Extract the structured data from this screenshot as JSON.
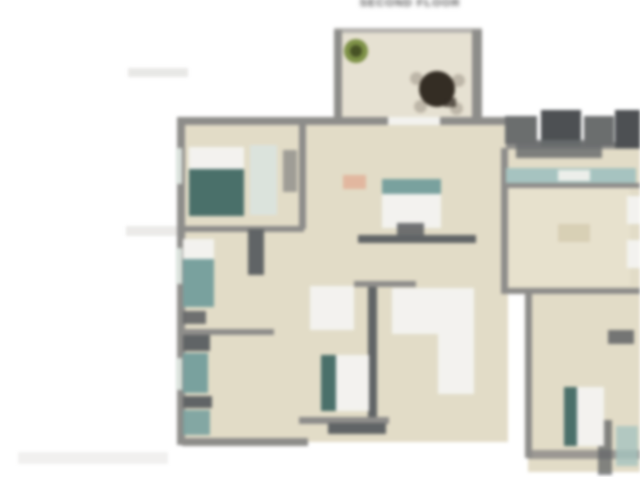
{
  "page": {
    "title": "SECOND FLOOR",
    "background": "#ffffff",
    "title_color": "#4a4a4a"
  },
  "palette": {
    "wall": "#8e8d8a",
    "wall_light": "#b8b6b1",
    "wall_dark": "#5f6365",
    "clutter": "#6a6d6e",
    "clutter_dark2": "#4b4f52",
    "floor": "#e6dfc7",
    "floor_light": "#ece6d2",
    "deck_floor": "#eae4d3",
    "white_soft": "#f7f6f2",
    "window": "#dde6df",
    "teal": "#76a3a0",
    "dark_teal": "#46706a",
    "counter_teal": "#a5c6c2",
    "plant_green": "#7d9340",
    "plant_dark": "#45511f",
    "table_dark": "#322a20",
    "chair_gray": "#c0b8a8",
    "salmon": "#e8b295",
    "tan_dark": "#d6cba9",
    "smudge": "#d9d7d3"
  },
  "floorplan": {
    "elements": [
      {
        "name": "bg-smudge-1",
        "x": 128,
        "y": 68,
        "w": 60,
        "h": 9,
        "color": "smudge",
        "opacity": 0.55
      },
      {
        "name": "bg-smudge-2",
        "x": 126,
        "y": 226,
        "w": 62,
        "h": 10,
        "color": "smudge",
        "opacity": 0.5
      },
      {
        "name": "deck-floor",
        "x": 336,
        "y": 32,
        "w": 146,
        "h": 94,
        "color": "deck_floor"
      },
      {
        "name": "deck-wall-top",
        "x": 334,
        "y": 28,
        "w": 148,
        "h": 5,
        "color": "wall_light"
      },
      {
        "name": "deck-wall-left",
        "x": 334,
        "y": 30,
        "w": 8,
        "h": 98,
        "color": "wall"
      },
      {
        "name": "deck-wall-right",
        "x": 472,
        "y": 30,
        "w": 10,
        "h": 98,
        "color": "wall"
      },
      {
        "name": "deck-plant",
        "shape": "circle",
        "x": 344,
        "y": 39,
        "w": 24,
        "h": 24,
        "color": "plant_green"
      },
      {
        "name": "deck-plant-core",
        "shape": "circle",
        "x": 350,
        "y": 45,
        "w": 12,
        "h": 12,
        "color": "plant_dark"
      },
      {
        "name": "patio-chair-1",
        "shape": "circle",
        "x": 410,
        "y": 72,
        "w": 13,
        "h": 13,
        "color": "chair_gray"
      },
      {
        "name": "patio-chair-2",
        "shape": "circle",
        "x": 452,
        "y": 74,
        "w": 13,
        "h": 13,
        "color": "chair_gray"
      },
      {
        "name": "patio-chair-3",
        "shape": "circle",
        "x": 414,
        "y": 100,
        "w": 13,
        "h": 13,
        "color": "chair_gray"
      },
      {
        "name": "patio-chair-4",
        "shape": "circle",
        "x": 450,
        "y": 102,
        "w": 13,
        "h": 13,
        "color": "chair_gray"
      },
      {
        "name": "patio-table",
        "shape": "circle",
        "x": 419,
        "y": 71,
        "w": 36,
        "h": 36,
        "color": "table_dark"
      },
      {
        "name": "patio-table-ext",
        "x": 444,
        "y": 98,
        "w": 12,
        "h": 9,
        "color": "table_dark",
        "opacity": 0.75
      },
      {
        "name": "floor-main",
        "x": 182,
        "y": 120,
        "w": 326,
        "h": 322,
        "color": "floor"
      },
      {
        "name": "floor-right",
        "x": 506,
        "y": 148,
        "w": 134,
        "h": 146,
        "color": "floor"
      },
      {
        "name": "floor-right-light",
        "x": 508,
        "y": 188,
        "w": 122,
        "h": 98,
        "color": "floor_light",
        "opacity": 0.7
      },
      {
        "name": "floor-right-bottom",
        "x": 528,
        "y": 290,
        "w": 112,
        "h": 182,
        "color": "floor"
      },
      {
        "name": "stair-landing",
        "x": 310,
        "y": 286,
        "w": 44,
        "h": 44,
        "color": "white_soft"
      },
      {
        "name": "stair-run-horizontal",
        "x": 392,
        "y": 288,
        "w": 82,
        "h": 46,
        "color": "white_soft"
      },
      {
        "name": "stair-run-vertical",
        "x": 438,
        "y": 288,
        "w": 36,
        "h": 106,
        "color": "white_soft"
      },
      {
        "name": "wall-top-main",
        "x": 182,
        "y": 117,
        "w": 326,
        "h": 8,
        "color": "wall"
      },
      {
        "name": "wall-top-right",
        "x": 506,
        "y": 142,
        "w": 134,
        "h": 7,
        "color": "wall"
      },
      {
        "name": "wall-left",
        "x": 177,
        "y": 117,
        "w": 8,
        "h": 328,
        "color": "wall"
      },
      {
        "name": "window-left-1",
        "x": 176,
        "y": 148,
        "w": 6,
        "h": 36,
        "color": "window"
      },
      {
        "name": "window-left-2",
        "x": 176,
        "y": 248,
        "w": 6,
        "h": 36,
        "color": "window"
      },
      {
        "name": "window-left-3",
        "x": 176,
        "y": 358,
        "w": 6,
        "h": 32,
        "color": "window"
      },
      {
        "name": "wall-divider-vertical-1",
        "x": 299,
        "y": 121,
        "w": 7,
        "h": 108,
        "color": "wall"
      },
      {
        "name": "wall-horizontal-left-1",
        "x": 182,
        "y": 226,
        "w": 122,
        "h": 6,
        "color": "wall"
      },
      {
        "name": "closet-dark",
        "x": 248,
        "y": 229,
        "w": 16,
        "h": 46,
        "color": "wall_dark"
      },
      {
        "name": "wall-horizontal-left-2",
        "x": 182,
        "y": 329,
        "w": 92,
        "h": 6,
        "color": "wall"
      },
      {
        "name": "wall-center-band",
        "x": 358,
        "y": 235,
        "w": 118,
        "h": 8,
        "color": "wall_dark"
      },
      {
        "name": "wall-vertical-center",
        "x": 368,
        "y": 281,
        "w": 9,
        "h": 140,
        "color": "wall_dark"
      },
      {
        "name": "wall-stair-top",
        "x": 354,
        "y": 281,
        "w": 62,
        "h": 6,
        "color": "wall"
      },
      {
        "name": "wall-vertical-right-1",
        "x": 501,
        "y": 148,
        "w": 7,
        "h": 146,
        "color": "wall"
      },
      {
        "name": "wall-horizontal-right",
        "x": 506,
        "y": 288,
        "w": 134,
        "h": 6,
        "color": "wall"
      },
      {
        "name": "wall-vertical-right-2",
        "x": 525,
        "y": 290,
        "w": 7,
        "h": 168,
        "color": "wall"
      },
      {
        "name": "wall-bottom-left",
        "x": 182,
        "y": 438,
        "w": 126,
        "h": 8,
        "color": "wall"
      },
      {
        "name": "wall-bottom-center",
        "x": 299,
        "y": 417,
        "w": 90,
        "h": 7,
        "color": "wall"
      },
      {
        "name": "wall-bottom-center-dark",
        "x": 328,
        "y": 423,
        "w": 58,
        "h": 11,
        "color": "wall_dark"
      },
      {
        "name": "wall-bottom-right",
        "x": 528,
        "y": 450,
        "w": 112,
        "h": 9,
        "color": "wall",
        "opacity": 0.85
      },
      {
        "name": "wall-right-bottom-vertical",
        "x": 598,
        "y": 420,
        "w": 14,
        "h": 55,
        "color": "wall_dark",
        "opacity": 0.75
      },
      {
        "name": "roof-clutter-1",
        "x": 505,
        "y": 116,
        "w": 32,
        "h": 28,
        "color": "clutter"
      },
      {
        "name": "roof-clutter-2",
        "x": 541,
        "y": 110,
        "w": 40,
        "h": 36,
        "color": "clutter_dark2"
      },
      {
        "name": "roof-clutter-3",
        "x": 584,
        "y": 116,
        "w": 30,
        "h": 30,
        "color": "clutter"
      },
      {
        "name": "roof-clutter-4",
        "x": 615,
        "y": 110,
        "w": 25,
        "h": 38,
        "color": "clutter_dark2"
      },
      {
        "name": "roof-clutter-5",
        "x": 516,
        "y": 140,
        "w": 86,
        "h": 18,
        "color": "clutter",
        "opacity": 0.85
      },
      {
        "name": "counter-strip",
        "x": 506,
        "y": 168,
        "w": 130,
        "h": 15,
        "color": "counter_teal"
      },
      {
        "name": "counter-white",
        "x": 558,
        "y": 170,
        "w": 32,
        "h": 11,
        "color": "white_soft",
        "opacity": 0.9
      },
      {
        "name": "wall-under-counter",
        "x": 506,
        "y": 183,
        "w": 134,
        "h": 5,
        "color": "wall"
      },
      {
        "name": "window-right-1",
        "x": 627,
        "y": 196,
        "w": 13,
        "h": 28,
        "color": "white_soft"
      },
      {
        "name": "window-right-2",
        "x": 627,
        "y": 240,
        "w": 13,
        "h": 28,
        "color": "white_soft"
      },
      {
        "name": "window-right-bottom",
        "x": 616,
        "y": 426,
        "w": 22,
        "h": 40,
        "color": "counter_teal",
        "opacity": 0.8
      },
      {
        "name": "bed1-mattress",
        "x": 189,
        "y": 147,
        "w": 55,
        "h": 24,
        "color": "white_soft"
      },
      {
        "name": "bed1-blanket",
        "x": 189,
        "y": 169,
        "w": 55,
        "h": 47,
        "color": "dark_teal"
      },
      {
        "name": "closet1",
        "x": 250,
        "y": 145,
        "w": 27,
        "h": 70,
        "color": "window"
      },
      {
        "name": "dresser1",
        "x": 283,
        "y": 150,
        "w": 14,
        "h": 42,
        "color": "wall",
        "opacity": 0.8
      },
      {
        "name": "bed2-mattress",
        "x": 183,
        "y": 239,
        "w": 31,
        "h": 22,
        "color": "white_soft"
      },
      {
        "name": "bed2-blanket",
        "x": 183,
        "y": 259,
        "w": 31,
        "h": 48,
        "color": "teal"
      },
      {
        "name": "nightstand2",
        "x": 183,
        "y": 311,
        "w": 23,
        "h": 13,
        "color": "wall_dark",
        "opacity": 0.9
      },
      {
        "name": "dresser-bottom-left-1",
        "x": 183,
        "y": 335,
        "w": 27,
        "h": 16,
        "color": "wall_dark"
      },
      {
        "name": "wardrobe-bottom-left",
        "x": 183,
        "y": 353,
        "w": 25,
        "h": 40,
        "color": "teal"
      },
      {
        "name": "dresser-bottom-left-2",
        "x": 183,
        "y": 396,
        "w": 29,
        "h": 12,
        "color": "wall_dark"
      },
      {
        "name": "cabinet-bottom-left",
        "x": 183,
        "y": 410,
        "w": 27,
        "h": 25,
        "color": "teal",
        "opacity": 0.9
      },
      {
        "name": "window-top-center",
        "x": 388,
        "y": 117,
        "w": 52,
        "h": 8,
        "color": "white_soft"
      },
      {
        "name": "rug-salmon",
        "x": 343,
        "y": 175,
        "w": 23,
        "h": 14,
        "color": "salmon",
        "opacity": 0.85
      },
      {
        "name": "bed3-headboard",
        "x": 382,
        "y": 179,
        "w": 59,
        "h": 17,
        "color": "teal"
      },
      {
        "name": "bed3-mattress",
        "x": 382,
        "y": 194,
        "w": 59,
        "h": 34,
        "color": "white_soft"
      },
      {
        "name": "bench3",
        "x": 397,
        "y": 223,
        "w": 27,
        "h": 13,
        "color": "wall_dark",
        "opacity": 0.9
      },
      {
        "name": "bed4-blanket",
        "x": 321,
        "y": 355,
        "w": 17,
        "h": 56,
        "color": "dark_teal"
      },
      {
        "name": "bed4-mattress",
        "x": 336,
        "y": 355,
        "w": 33,
        "h": 56,
        "color": "white_soft"
      },
      {
        "name": "table-right",
        "x": 558,
        "y": 224,
        "w": 32,
        "h": 18,
        "color": "tan_dark",
        "opacity": 0.7
      },
      {
        "name": "dresser-right-bottom",
        "x": 608,
        "y": 330,
        "w": 26,
        "h": 14,
        "color": "wall_dark",
        "opacity": 0.85
      },
      {
        "name": "bed5-blanket",
        "x": 564,
        "y": 387,
        "w": 15,
        "h": 59,
        "color": "dark_teal"
      },
      {
        "name": "bed5-mattress",
        "x": 577,
        "y": 387,
        "w": 27,
        "h": 59,
        "color": "white_soft"
      },
      {
        "name": "watermark-smudge",
        "x": 18,
        "y": 452,
        "w": 150,
        "h": 12,
        "color": "smudge",
        "opacity": 0.35
      }
    ]
  }
}
